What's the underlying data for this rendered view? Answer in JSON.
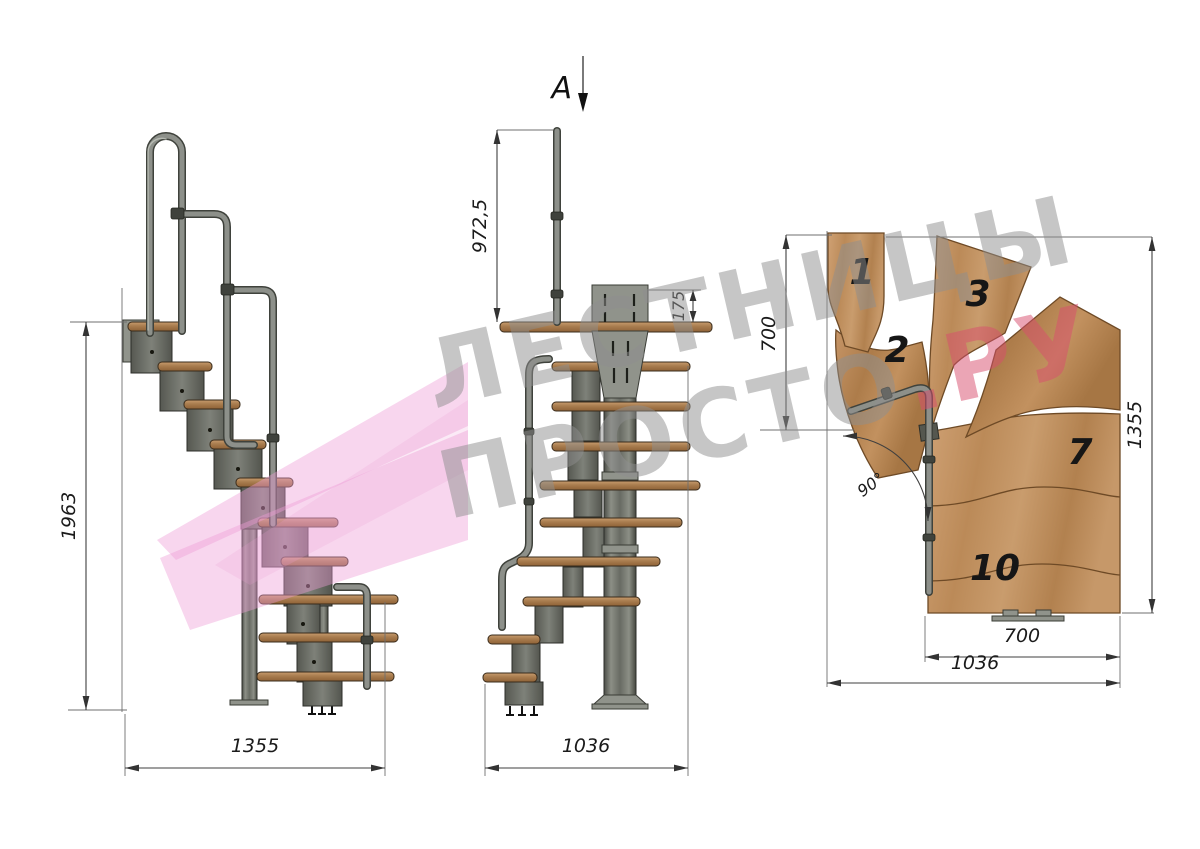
{
  "watermark": {
    "line1": "ЛЕСТНИЦЫ",
    "line2_gray": "ПРОСТО",
    "line2_accent": ".РУ",
    "gray_color": "#8f8f8f",
    "accent_color": "#d94e6e",
    "ribbon_color": "#ef9ed7"
  },
  "side_view": {
    "dim_height": "1963",
    "dim_width": "1355"
  },
  "front_view": {
    "section_label": "A",
    "dim_rail_height": "972,5",
    "dim_bracket_height": "175",
    "dim_width": "1036"
  },
  "plan_view": {
    "dim_left_height": "700",
    "dim_right_height": "1355",
    "dim_tread_width": "700",
    "dim_total_width": "1036",
    "dim_angle": "90°",
    "tread_numbers": [
      "1",
      "2",
      "3",
      "7",
      "10"
    ]
  },
  "colors": {
    "background": "#ffffff",
    "wood_light": "#c89a6a",
    "wood_dark": "#9f7245",
    "steel": "#70736b",
    "steel_dark": "#3c3e38",
    "dim_line": "#3f3f3f"
  }
}
